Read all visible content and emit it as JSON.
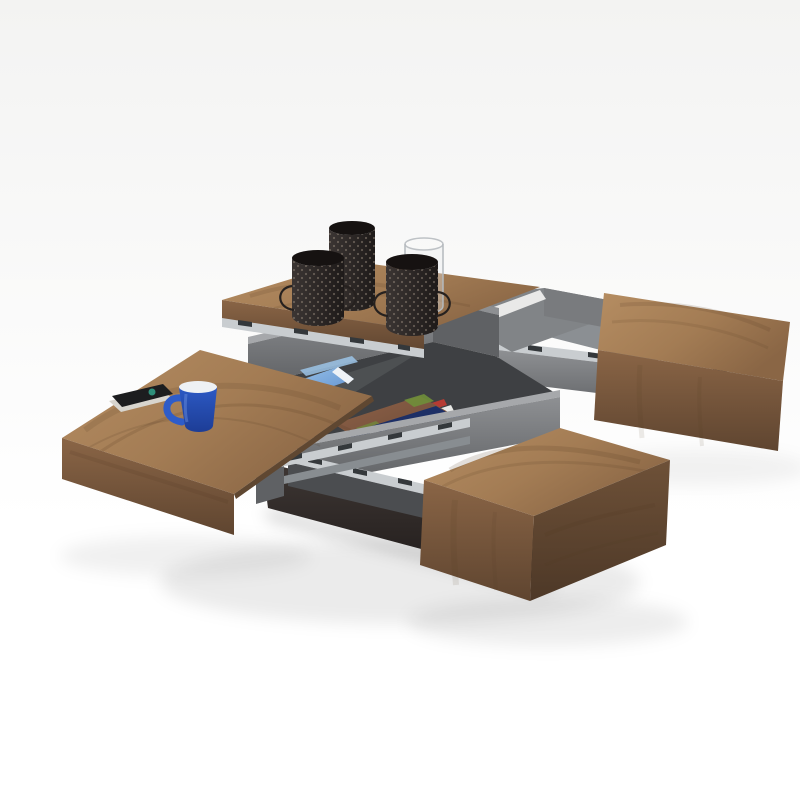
{
  "image": {
    "title": "Modern square coffee table with four sliding walnut lids opened, revealing grey storage compartments on telescopic metal slides"
  },
  "scene": {
    "background_top": "#f3f3f2",
    "background_bottom": "#ffffff",
    "shadow": "#000000"
  },
  "palette": {
    "wood_top_light": "#b58d62",
    "wood_top_mid": "#a37c54",
    "wood_top_dark": "#8a6645",
    "wood_front_light": "#8a6546",
    "wood_front_dark": "#5f4530",
    "wood_side": "#6e5138",
    "wood_side_dark": "#4d3827",
    "wood_edge": "#5f4731",
    "grain": "#4f3620",
    "grey_lip": "#a6a8ab",
    "grey_wall_light": "#8e9093",
    "grey_wall": "#797b7e",
    "grey_wall_dark": "#5f6164",
    "grey_wall_darker": "#4b4d50",
    "interior": "#3e4043",
    "interior_light": "#595c5f",
    "floor_grey": "#818487",
    "drawer_floor": "#8b8f93",
    "metal_light": "#c9cdd0",
    "metal": "#a9aeb2",
    "metal_dark": "#888d91",
    "slide_mark": "#34383b",
    "plinth_top": "#3e3734",
    "plinth_bottom": "#1f1a19",
    "gap_light": "#f4f4f3",
    "mug_blue": "#2e5cc9",
    "mug_blue_dark": "#1d3d96",
    "mug_inner": "#eef1f4",
    "mug_rim": "#c9ced4",
    "notebook": "#1c1d1f",
    "notebook_pages": "#d8d5ce",
    "notebook_logo": "#2e8f7a",
    "magazine_blue": "#5d8fd0",
    "magazine_blue_light": "#9cc4e8",
    "magazine_white": "#eef2f6",
    "book_white": "#f2f1ee",
    "book_pages": "#e0ddd6",
    "book_pages_dark": "#d3d0c9",
    "book_seal": "#b0372e",
    "mag_skin": "#8f6248",
    "mag_skin_dark": "#6b4a38",
    "mag_green": "#6f8f3a",
    "mag_strip": "#1d2f66",
    "mag_text": "#ffffff",
    "spine_red": "#b63b33",
    "spine_white": "#e8e8e6",
    "spine_blue": "#32549c",
    "candle_dark": "#3b3533",
    "candle_darker": "#1e1a19",
    "candle_dot": "#9b8d80",
    "candle_hole": "#161211",
    "candle_wire": "#26211f",
    "glass_stroke": "#b4b9bd",
    "glass_fill": "#e9ecee"
  },
  "objects": {
    "base": "dark espresso plinth base",
    "compartments": "grey storage compartments with telescopic drawer slides",
    "back_lid": "walnut sliding lid (back) with candle holders",
    "right_lid": "walnut sliding drawer box (right)",
    "left_lid": "walnut sliding lid (left) with blue mug and black notebook",
    "front_lid": "walnut sliding drawer box (front)",
    "decor": "quilted candle holders and glass hurricane",
    "contents": "blue magazine, face magazine, colorful book spines, white book with red seal"
  }
}
